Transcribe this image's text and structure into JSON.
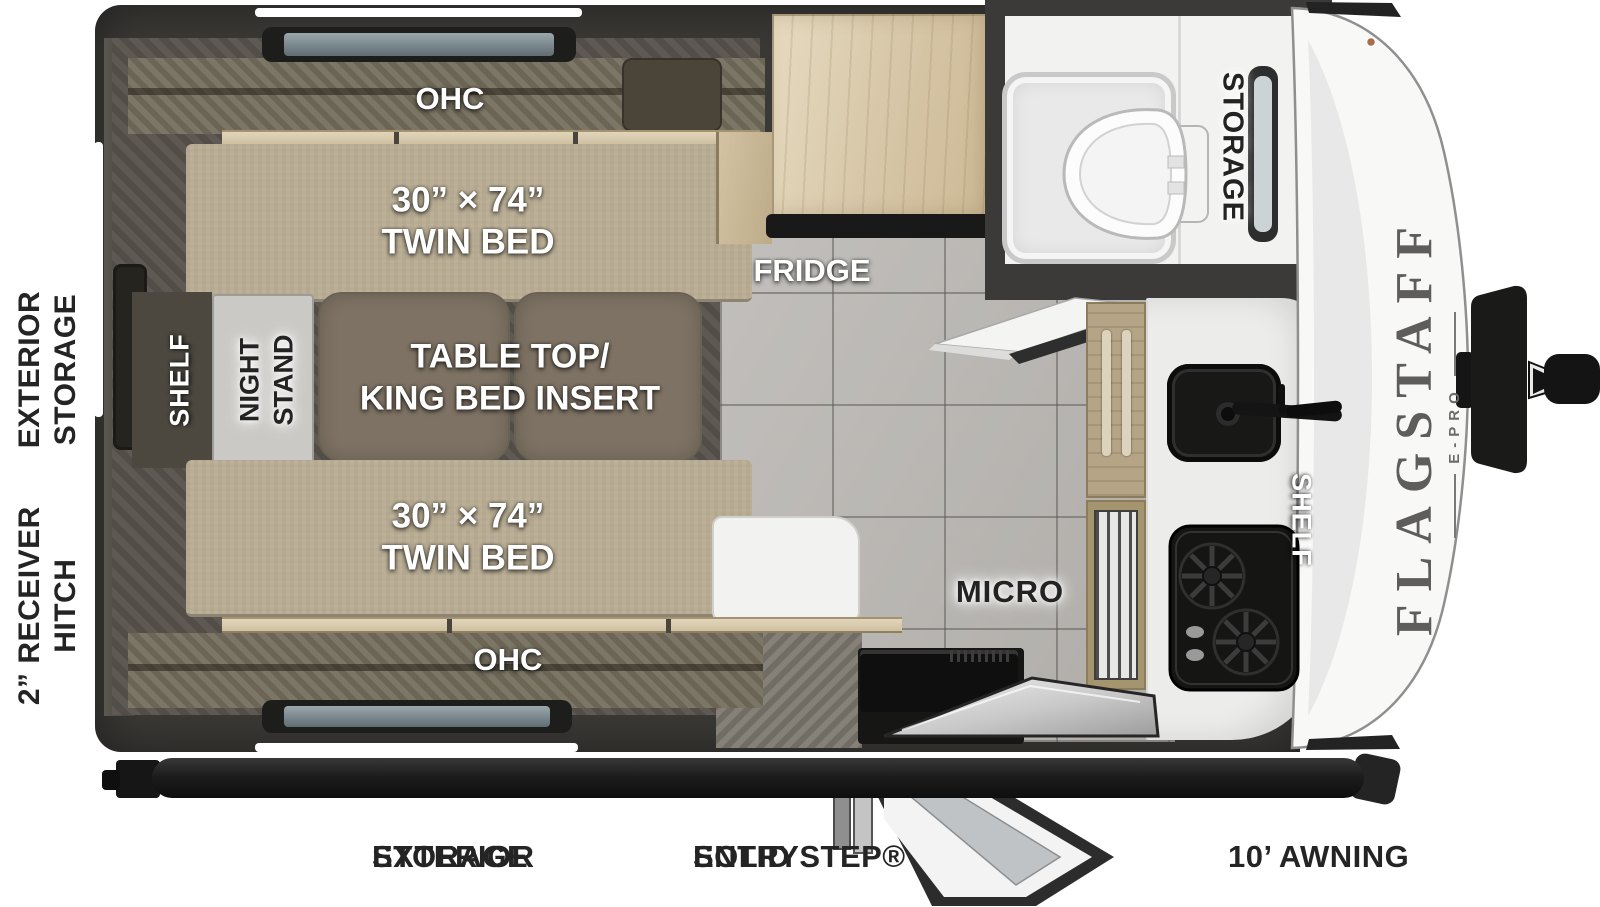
{
  "brand": {
    "name": "FLAGSTAFF",
    "sub": "E-PRO"
  },
  "exterior": {
    "left_labels": [
      {
        "l1": "2” RECEIVER",
        "l2": "HITCH"
      },
      {
        "l1": "EXTERIOR",
        "l2": "STORAGE"
      }
    ],
    "bottom_labels": [
      {
        "l1": "EXTERIOR",
        "l2": "STORAGE"
      },
      {
        "l1": "SOLID STEP®",
        "l2": "ENTRY"
      },
      {
        "l1": "10’ AWNING",
        "l2": ""
      }
    ]
  },
  "rooms": {
    "bedroom": {
      "ohc_top": "OHC",
      "ohc_bottom": "OHC",
      "bed_top": {
        "l1": "30” × 74”",
        "l2": "TWIN BED"
      },
      "bed_bottom": {
        "l1": "30” × 74”",
        "l2": "TWIN BED"
      },
      "shelf": "SHELF",
      "night_stand": {
        "l1": "NIGHT",
        "l2": "STAND"
      },
      "table": {
        "l1": "TABLE TOP/",
        "l2": "KING BED INSERT"
      }
    },
    "kitchen": {
      "fridge": "FRIDGE",
      "micro": "MICRO",
      "shelf": "SHELF"
    },
    "bath": {
      "storage": "STORAGE"
    }
  },
  "colors": {
    "wall": "#3a3936",
    "bedroom_floor": "#55514a",
    "tile_floor": "#b9b6b2",
    "bed": "#b9ad94",
    "wood_light": "#d9cbb1",
    "wood_mid": "#b5a486",
    "table": "#7d7263",
    "counter": "#ececeb",
    "appliance_black": "#151514",
    "bath_white": "#f2f2f1",
    "cap_white": "#f8f8f7",
    "label_dark": "#242424"
  }
}
